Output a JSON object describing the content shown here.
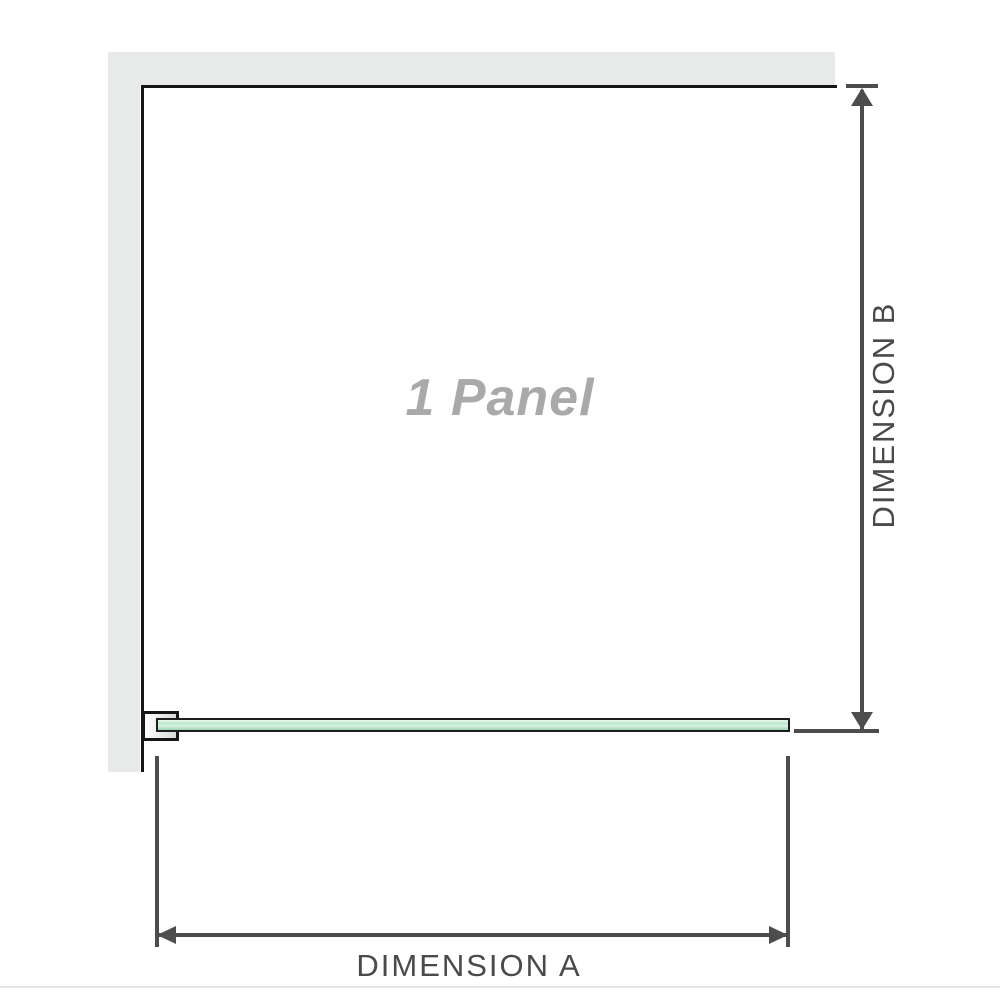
{
  "diagram": {
    "panel_label": "1 Panel",
    "dimension_a_label": "DIMENSION A",
    "dimension_b_label": "DIMENSION B"
  },
  "icons": {
    "arrow_up": "arrowhead pointing up",
    "arrow_down": "arrowhead pointing down",
    "arrow_left": "arrowhead pointing left",
    "arrow_right": "arrowhead pointing right"
  },
  "colors": {
    "wall": "#e8e9e9",
    "outline": "#161616",
    "dimension": "#4d4d4d",
    "label_text": "#4a4a4a",
    "panel_text": "#a9a9a9",
    "glass_top": "#e8f7ee",
    "glass_mid": "#b9e5c9",
    "glass_streak": "#dff3e6",
    "glass_main": "#98d5b1",
    "bracket_light": "#fdfdfd",
    "bracket_dark": "#d8dada",
    "divider": "#e4e6e6"
  }
}
